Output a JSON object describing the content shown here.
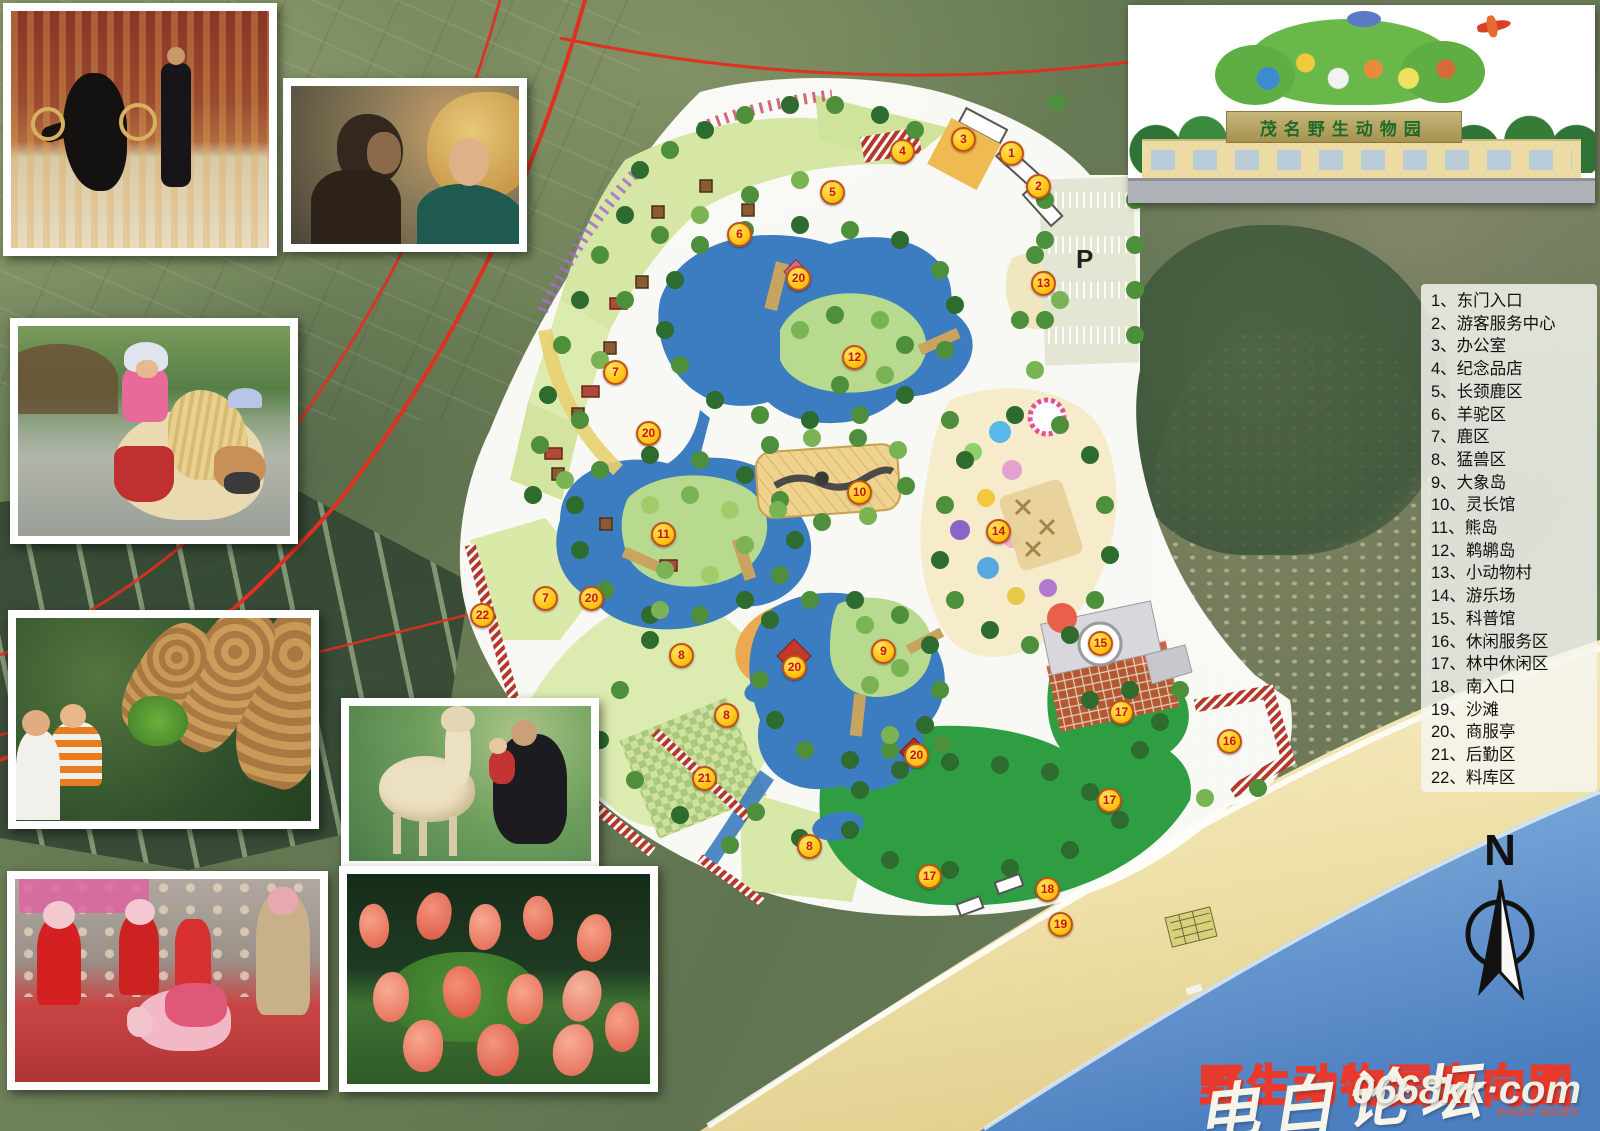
{
  "title": {
    "text": "野生动物园意向图"
  },
  "watermark": {
    "script": "电白论坛",
    "url": "0668kk·com",
    "small": "南海首粤 海影媒体"
  },
  "entrance_panel": {
    "sign_text": "茂名野生动物园"
  },
  "north": {
    "label": "N"
  },
  "legend": {
    "items": [
      {
        "num": "1",
        "label": "东门入口"
      },
      {
        "num": "2",
        "label": "游客服务中心"
      },
      {
        "num": "3",
        "label": "办公室"
      },
      {
        "num": "4",
        "label": "纪念品店"
      },
      {
        "num": "5",
        "label": "长颈鹿区"
      },
      {
        "num": "6",
        "label": "羊驼区"
      },
      {
        "num": "7",
        "label": "鹿区"
      },
      {
        "num": "8",
        "label": "猛兽区"
      },
      {
        "num": "9",
        "label": "大象岛"
      },
      {
        "num": "10",
        "label": "灵长馆"
      },
      {
        "num": "11",
        "label": "熊岛"
      },
      {
        "num": "12",
        "label": "鹈鹕岛"
      },
      {
        "num": "13",
        "label": "小动物村"
      },
      {
        "num": "14",
        "label": "游乐场"
      },
      {
        "num": "15",
        "label": "科普馆"
      },
      {
        "num": "16",
        "label": "休闲服务区"
      },
      {
        "num": "17",
        "label": "林中休闲区"
      },
      {
        "num": "18",
        "label": "南入口"
      },
      {
        "num": "19",
        "label": "沙滩"
      },
      {
        "num": "20",
        "label": "商服亭"
      },
      {
        "num": "21",
        "label": "后勤区"
      },
      {
        "num": "22",
        "label": "料库区"
      }
    ]
  },
  "map": {
    "parking_label": "P",
    "markers": [
      {
        "label": "1",
        "x": 1010,
        "y": 152
      },
      {
        "label": "2",
        "x": 1037,
        "y": 185
      },
      {
        "label": "3",
        "x": 962,
        "y": 138
      },
      {
        "label": "4",
        "x": 901,
        "y": 150
      },
      {
        "label": "5",
        "x": 831,
        "y": 191
      },
      {
        "label": "6",
        "x": 738,
        "y": 233
      },
      {
        "label": "7",
        "x": 614,
        "y": 371
      },
      {
        "label": "7",
        "x": 544,
        "y": 597
      },
      {
        "label": "8",
        "x": 680,
        "y": 654
      },
      {
        "label": "8",
        "x": 725,
        "y": 714
      },
      {
        "label": "8",
        "x": 808,
        "y": 845
      },
      {
        "label": "9",
        "x": 882,
        "y": 650
      },
      {
        "label": "10",
        "x": 858,
        "y": 491
      },
      {
        "label": "11",
        "x": 662,
        "y": 533
      },
      {
        "label": "12",
        "x": 853,
        "y": 356
      },
      {
        "label": "13",
        "x": 1042,
        "y": 282
      },
      {
        "label": "14",
        "x": 997,
        "y": 530
      },
      {
        "label": "15",
        "x": 1099,
        "y": 642
      },
      {
        "label": "16",
        "x": 1228,
        "y": 740
      },
      {
        "label": "17",
        "x": 1120,
        "y": 711
      },
      {
        "label": "17",
        "x": 1108,
        "y": 799
      },
      {
        "label": "17",
        "x": 928,
        "y": 875
      },
      {
        "label": "18",
        "x": 1046,
        "y": 888
      },
      {
        "label": "19",
        "x": 1059,
        "y": 923
      },
      {
        "label": "20",
        "x": 797,
        "y": 277
      },
      {
        "label": "20",
        "x": 647,
        "y": 432
      },
      {
        "label": "20",
        "x": 590,
        "y": 597
      },
      {
        "label": "20",
        "x": 793,
        "y": 666
      },
      {
        "label": "20",
        "x": 915,
        "y": 754
      },
      {
        "label": "21",
        "x": 703,
        "y": 777
      },
      {
        "label": "22",
        "x": 481,
        "y": 614
      }
    ]
  },
  "colors": {
    "lake_blue": "#3c7cc0",
    "lawn_green": "#d9e8ac",
    "forest_green": "#2f9e42",
    "sand": "#efe1a8",
    "sea": "#5d8fc9",
    "marker_yellow": "#ffc614",
    "title_red": "#e8392a",
    "wall_red": "#b5382a"
  }
}
